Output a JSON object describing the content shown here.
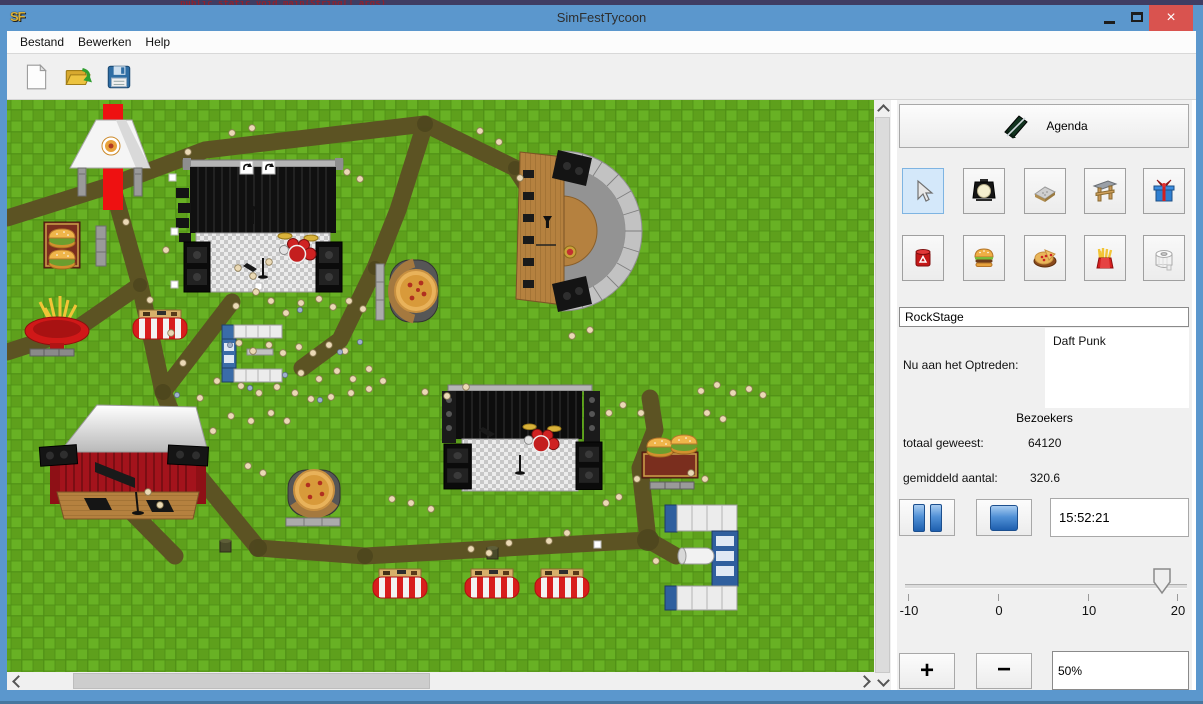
{
  "window": {
    "title": "SimFestTycoon",
    "app_icon_text": "SF",
    "close_glyph": "×"
  },
  "background": {
    "code_fragment": "public static void main(String[] args)"
  },
  "menu_bar": {
    "items": [
      "Bestand",
      "Bewerken",
      "Help"
    ]
  },
  "toolbar": {
    "buttons": [
      "new-file",
      "open-file",
      "save-file"
    ]
  },
  "sidebar": {
    "agenda_button": "Agenda",
    "tool_rows": [
      [
        "select-cursor",
        "spotlight",
        "path-tile",
        "stage-gate",
        "gift-shop"
      ],
      [
        "trash-can",
        "burger-stand",
        "pizza-stand",
        "fries-stand",
        "toilet"
      ]
    ],
    "selected_tool": "select-cursor",
    "stage_name": "RockStage",
    "now_performing_label": "Nu aan het Optreden:",
    "now_performing_artist": "Daft Punk",
    "visitors_header": "Bezoekers",
    "visitors_total_label": "totaal geweest:",
    "visitors_total_value": "64120",
    "visitors_avg_label": "gemiddeld aantal:",
    "visitors_avg_value": "320.6",
    "clock": "15:52:21",
    "speed_slider": {
      "tick_labels": [
        "-10",
        "0",
        "10",
        "20"
      ],
      "min": -10,
      "max": 20,
      "value": 20
    },
    "zoom_controls": {
      "zoom_in": "+",
      "zoom_out": "−",
      "zoom_level": "50%"
    }
  },
  "canvas": {
    "map_objects": [
      "food-tent",
      "red-carpet",
      "main-stage",
      "band-shell",
      "burger-stand-left",
      "fries-stand",
      "market-stall",
      "toilet-block-left",
      "pizza-table",
      "roofed-stage",
      "pizza-table-2",
      "center-stage",
      "burger-stand-right",
      "toilet-block-right",
      "barrier-stall-1",
      "barrier-stall-2",
      "barrier-stall-3",
      "visitors",
      "paths"
    ]
  },
  "colors": {
    "titlebar": "#5b97cd",
    "close_button": "#d9534f",
    "grass": "#61a81e",
    "path": "#5c5323",
    "selected_tool_bg": "#d4e8fa"
  }
}
